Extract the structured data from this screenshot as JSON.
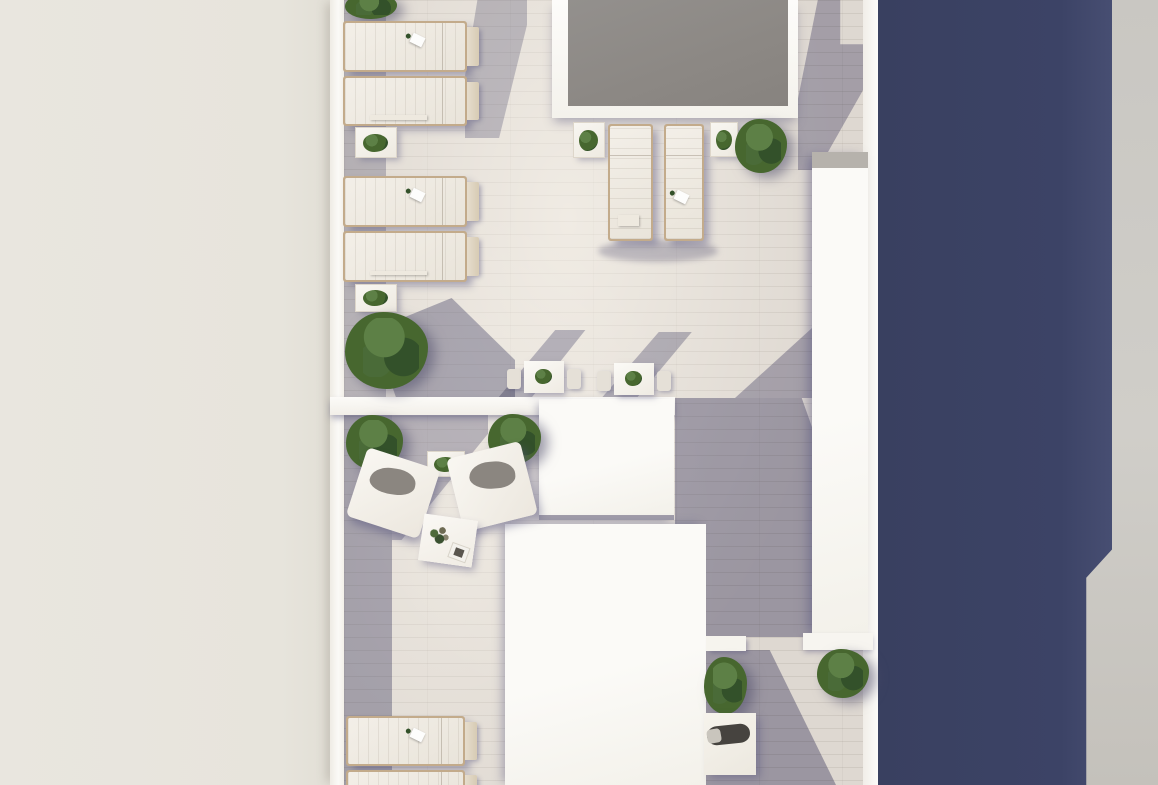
{
  "scene": {
    "type": "architectural-3d-render",
    "view": "top-down",
    "subject": "rooftop terrace with pool deck, sun loungers, lounge seating and shrubs",
    "canvas": {
      "width": 1158,
      "height": 785
    }
  },
  "palette": {
    "left_background": "#e9e6df",
    "right_background": "#c9c7c2",
    "shadow_wall_navy": "#3c4366",
    "tile_sunlit": "#ded8d1",
    "shadow_tint": "#56547e",
    "building_white": "#fbfaf7",
    "pool_gray": "#8c8884",
    "fabric_white": "#f3efe8",
    "frame_tan": "#c3ab8b",
    "cushion_gray": "#8b8680",
    "daybed_cushion": "#46433f",
    "plant_green": "#47672f",
    "plant_green_light": "#5d8046",
    "plant_green_dark": "#33512a"
  },
  "items": [
    {
      "name": "shrub-top-left",
      "type": "shrub",
      "x": 344,
      "y": -8,
      "w": 56,
      "h": 28
    },
    {
      "name": "sun-lounger-1",
      "type": "lounger-h",
      "x": 343,
      "y": 21,
      "w": 124,
      "h": 51,
      "deco": true
    },
    {
      "name": "sun-lounger-2",
      "type": "lounger-h",
      "x": 343,
      "y": 76,
      "w": 124,
      "h": 50,
      "towel": true
    },
    {
      "name": "side-table-1",
      "type": "side-table",
      "x": 355,
      "y": 127,
      "w": 42,
      "h": 31
    },
    {
      "name": "sun-lounger-3",
      "type": "lounger-h",
      "x": 343,
      "y": 176,
      "w": 124,
      "h": 51,
      "deco": true
    },
    {
      "name": "sun-lounger-4",
      "type": "lounger-h",
      "x": 343,
      "y": 231,
      "w": 124,
      "h": 51,
      "towel": true
    },
    {
      "name": "side-table-2",
      "type": "side-table",
      "x": 355,
      "y": 284,
      "w": 42,
      "h": 28
    },
    {
      "name": "shrub-left",
      "type": "shrub",
      "x": 343,
      "y": 310,
      "w": 90,
      "h": 82
    },
    {
      "name": "poolside-table-left",
      "type": "side-table",
      "x": 573,
      "y": 122,
      "w": 32,
      "h": 36
    },
    {
      "name": "poolside-lounger-1",
      "type": "lounger-v",
      "x": 608,
      "y": 124,
      "w": 45,
      "h": 117,
      "towel": true
    },
    {
      "name": "poolside-lounger-2",
      "type": "lounger-v",
      "x": 664,
      "y": 124,
      "w": 40,
      "h": 117,
      "deco": true
    },
    {
      "name": "poolside-table-right",
      "type": "side-table",
      "x": 710,
      "y": 122,
      "w": 28,
      "h": 35
    },
    {
      "name": "poolside-shrub",
      "type": "shrub",
      "x": 734,
      "y": 118,
      "w": 56,
      "h": 57
    },
    {
      "name": "bistro-set-1",
      "type": "bistro",
      "x": 507,
      "y": 361,
      "w": 74,
      "h": 35
    },
    {
      "name": "bistro-set-2",
      "type": "bistro",
      "x": 597,
      "y": 363,
      "w": 74,
      "h": 35
    },
    {
      "name": "lounge-shrub-left",
      "type": "shrub",
      "x": 345,
      "y": 414,
      "w": 62,
      "h": 58
    },
    {
      "name": "lounge-shrub-right",
      "type": "shrub",
      "x": 487,
      "y": 413,
      "w": 57,
      "h": 53
    },
    {
      "name": "lounge-side-table",
      "type": "side-table",
      "x": 427,
      "y": 451,
      "w": 38,
      "h": 26
    },
    {
      "name": "armchair-left",
      "type": "armchair",
      "x": 355,
      "y": 457,
      "w": 76,
      "h": 72,
      "rot": 18
    },
    {
      "name": "armchair-right",
      "type": "armchair",
      "x": 454,
      "y": 449,
      "w": 76,
      "h": 75,
      "rot": -14,
      "flip": true
    },
    {
      "name": "coffee-table",
      "type": "coffee-table",
      "x": 421,
      "y": 517,
      "w": 54,
      "h": 47,
      "rot": 8
    },
    {
      "name": "planter-bench",
      "type": "planter",
      "x": 706,
      "y": 636,
      "w": 40,
      "h": 15
    },
    {
      "name": "bottom-shrub-left",
      "type": "shrub",
      "x": 703,
      "y": 656,
      "w": 47,
      "h": 60
    },
    {
      "name": "daybed",
      "type": "daybed",
      "x": 704,
      "y": 713,
      "w": 52,
      "h": 62
    },
    {
      "name": "bottom-shrub-right",
      "type": "shrub",
      "x": 816,
      "y": 648,
      "w": 56,
      "h": 52
    },
    {
      "name": "sun-lounger-5",
      "type": "lounger-h",
      "x": 346,
      "y": 716,
      "w": 119,
      "h": 50,
      "deco": true
    },
    {
      "name": "sun-lounger-6",
      "type": "lounger-h",
      "x": 346,
      "y": 770,
      "w": 119,
      "h": 40
    }
  ]
}
